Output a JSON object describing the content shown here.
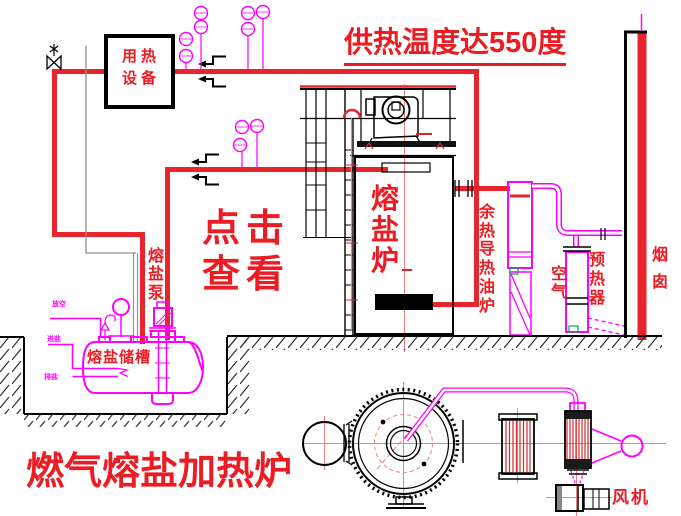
{
  "colors": {
    "pipe_red": "#e8252c",
    "text_red": "#ec1c24",
    "cad_magenta": "#ff00ff",
    "centerline_red": "#ef8080",
    "thin_gray": "#8f8f8f",
    "detail_green": "#00a651",
    "line_black": "#000000"
  },
  "labels": {
    "temperature_note": "供热温度达550度",
    "heat_equipment": "用热设备",
    "click_view": "点击查看",
    "salt_furnace": "熔盐炉",
    "salt_pump": "熔盐泵",
    "salt_tank": "熔盐储槽",
    "waste_heat_oil_furnace": "余热导热油炉",
    "air": "空气",
    "preheater": "预热器",
    "chimney": "烟囱",
    "fan": "风机",
    "title": "燃气熔盐加热炉",
    "tank_nozzles": [
      "放空",
      "进盐",
      "排盐"
    ]
  }
}
